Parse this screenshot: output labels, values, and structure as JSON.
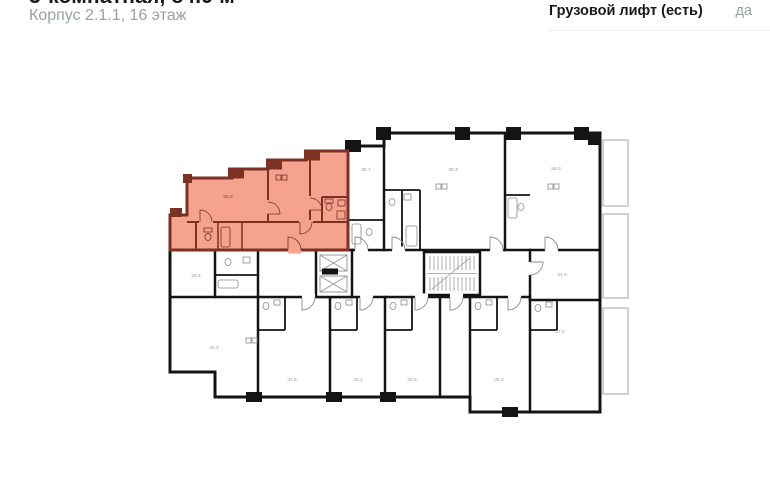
{
  "header": {
    "title": "3-комнатная, 84.9 м²",
    "subtitle": "Корпус 2.1.1, 16 этаж",
    "spec_row": {
      "label": "Грузовой лифт (есть)",
      "value": "да"
    }
  },
  "plan": {
    "colors": {
      "highlight_fill": "#f5a28e",
      "highlight_wall": "#7c3122",
      "wall": "#141414",
      "fixture_line": "#8a8a8a"
    },
    "rooms": [
      {
        "name": "highlighted-apartment",
        "label": "84.9"
      },
      {
        "name": "room-left-middle",
        "label": "29.2"
      },
      {
        "name": "room-top-a",
        "label": "35.7"
      },
      {
        "name": "room-top-b",
        "label": "39.3"
      },
      {
        "name": "room-top-c",
        "label": "59.3"
      },
      {
        "name": "room-right-middle",
        "label": "31.9"
      },
      {
        "name": "room-right-lower",
        "label": "37.5"
      },
      {
        "name": "room-bottom-1",
        "label": "44.3"
      },
      {
        "name": "room-bottom-2",
        "label": "37.6"
      },
      {
        "name": "room-bottom-3",
        "label": "29.1"
      },
      {
        "name": "room-bottom-4",
        "label": "29.5"
      },
      {
        "name": "room-bottom-5",
        "label": "36.2"
      }
    ]
  }
}
